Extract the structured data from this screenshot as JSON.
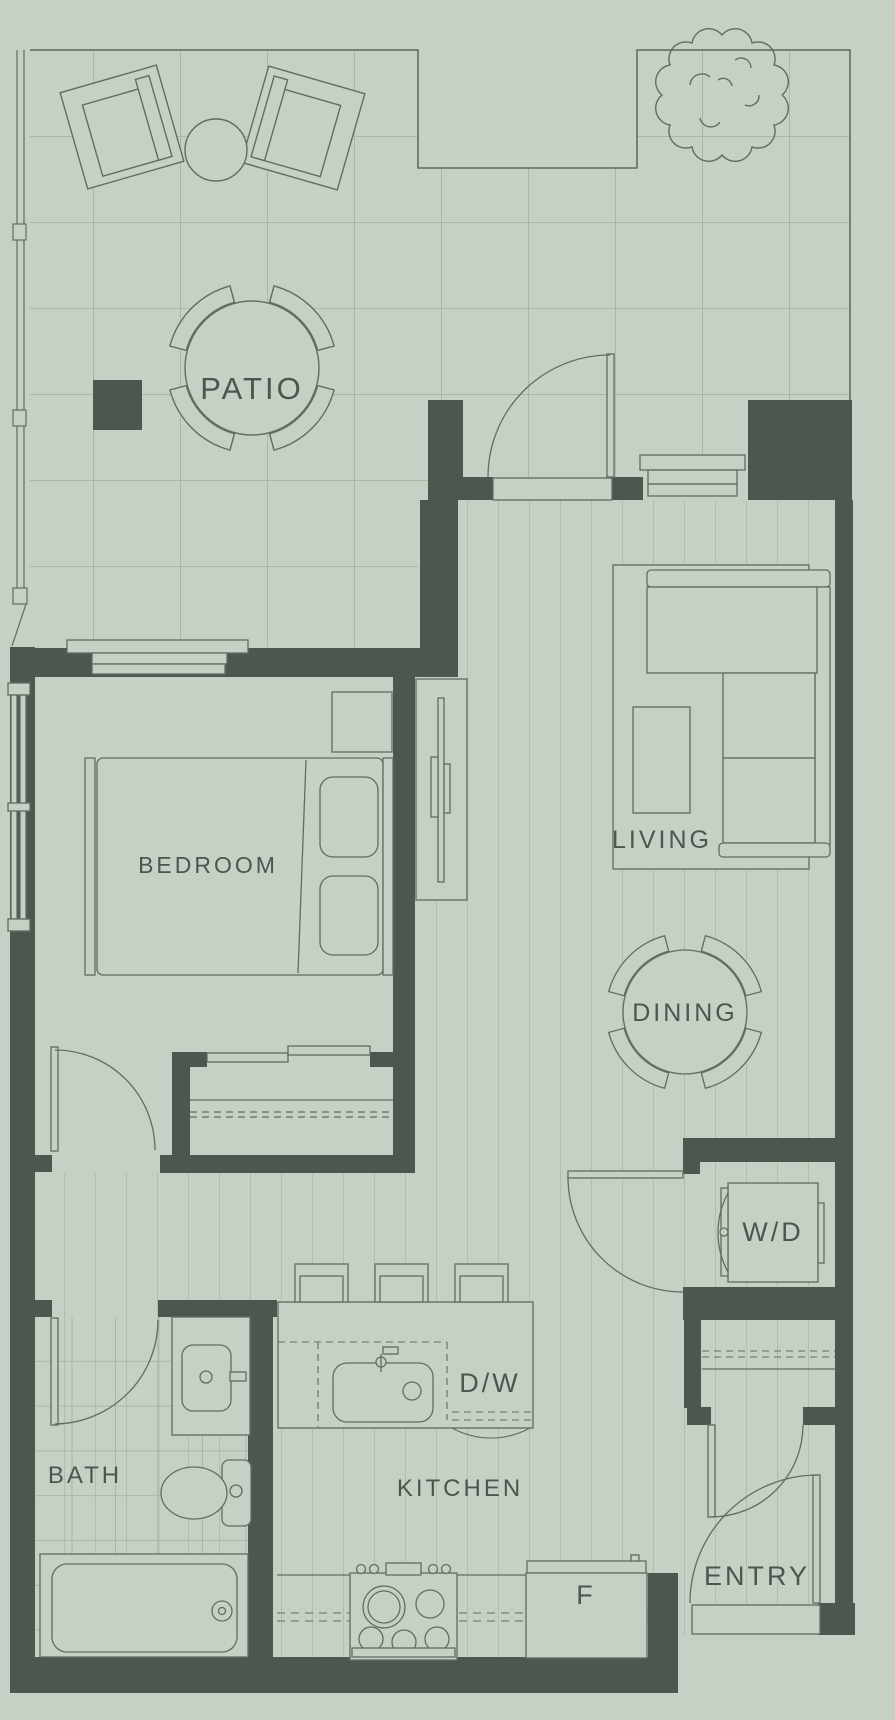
{
  "floorplan": {
    "palette": {
      "background": "#c5d1c5",
      "wall": "#4d574f",
      "outline": "#5f6e62",
      "grid": "#a7b7a8",
      "label": "#4b574e"
    },
    "rooms": {
      "patio": "PATIO",
      "bedroom": "BEDROOM",
      "living": "LIVING",
      "dining": "DINING",
      "washer_dryer": "W/D",
      "bath": "BATH",
      "kitchen": "KITCHEN",
      "dishwasher": "D/W",
      "fridge": "F",
      "entry": "ENTRY"
    }
  }
}
